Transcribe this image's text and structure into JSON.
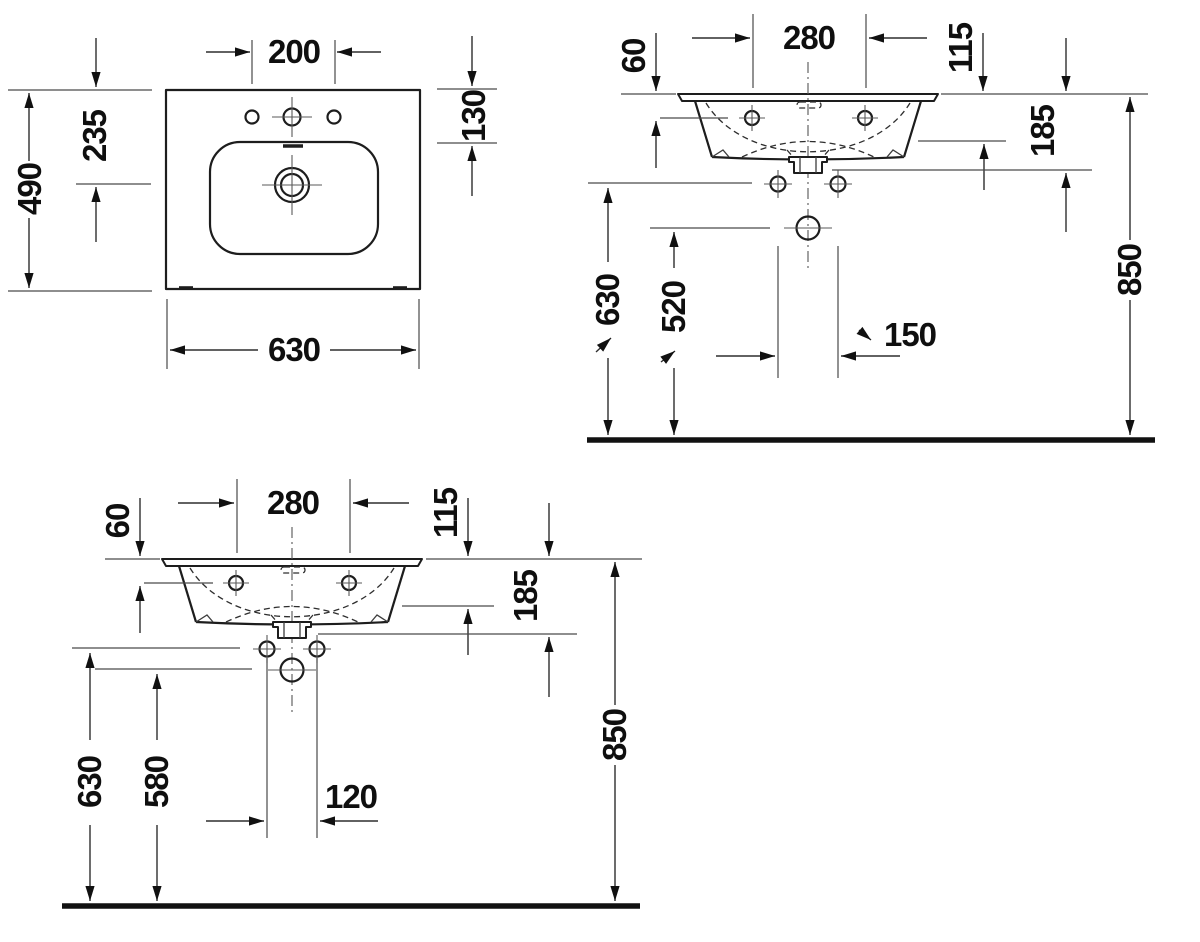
{
  "drawing": {
    "background": "#ffffff",
    "line_color": "#1d1d1d",
    "text_color": "#0f0f0f",
    "views": {
      "plan": {
        "label": "top-view",
        "dims": {
          "hole_spacing": "200",
          "rim_to_bowl": "130",
          "rim_to_drain": "235",
          "depth_overall": "490",
          "width_overall": "630"
        }
      },
      "front_150": {
        "label": "front-view-150",
        "dims": {
          "fixing_spacing": "280",
          "rim_to_hole": "60",
          "rim_to_bowl_bottom": "115",
          "rim_to_outlet": "185",
          "supply_height": "630",
          "waste_height": "520",
          "supply_spacing": "150",
          "rim_height": "850"
        }
      },
      "front_120": {
        "label": "front-view-120",
        "dims": {
          "fixing_spacing": "280",
          "rim_to_hole": "60",
          "rim_to_bowl_bottom": "115",
          "rim_to_outlet": "185",
          "supply_height": "630",
          "waste_height": "580",
          "supply_spacing": "120",
          "rim_height": "850"
        }
      }
    }
  }
}
